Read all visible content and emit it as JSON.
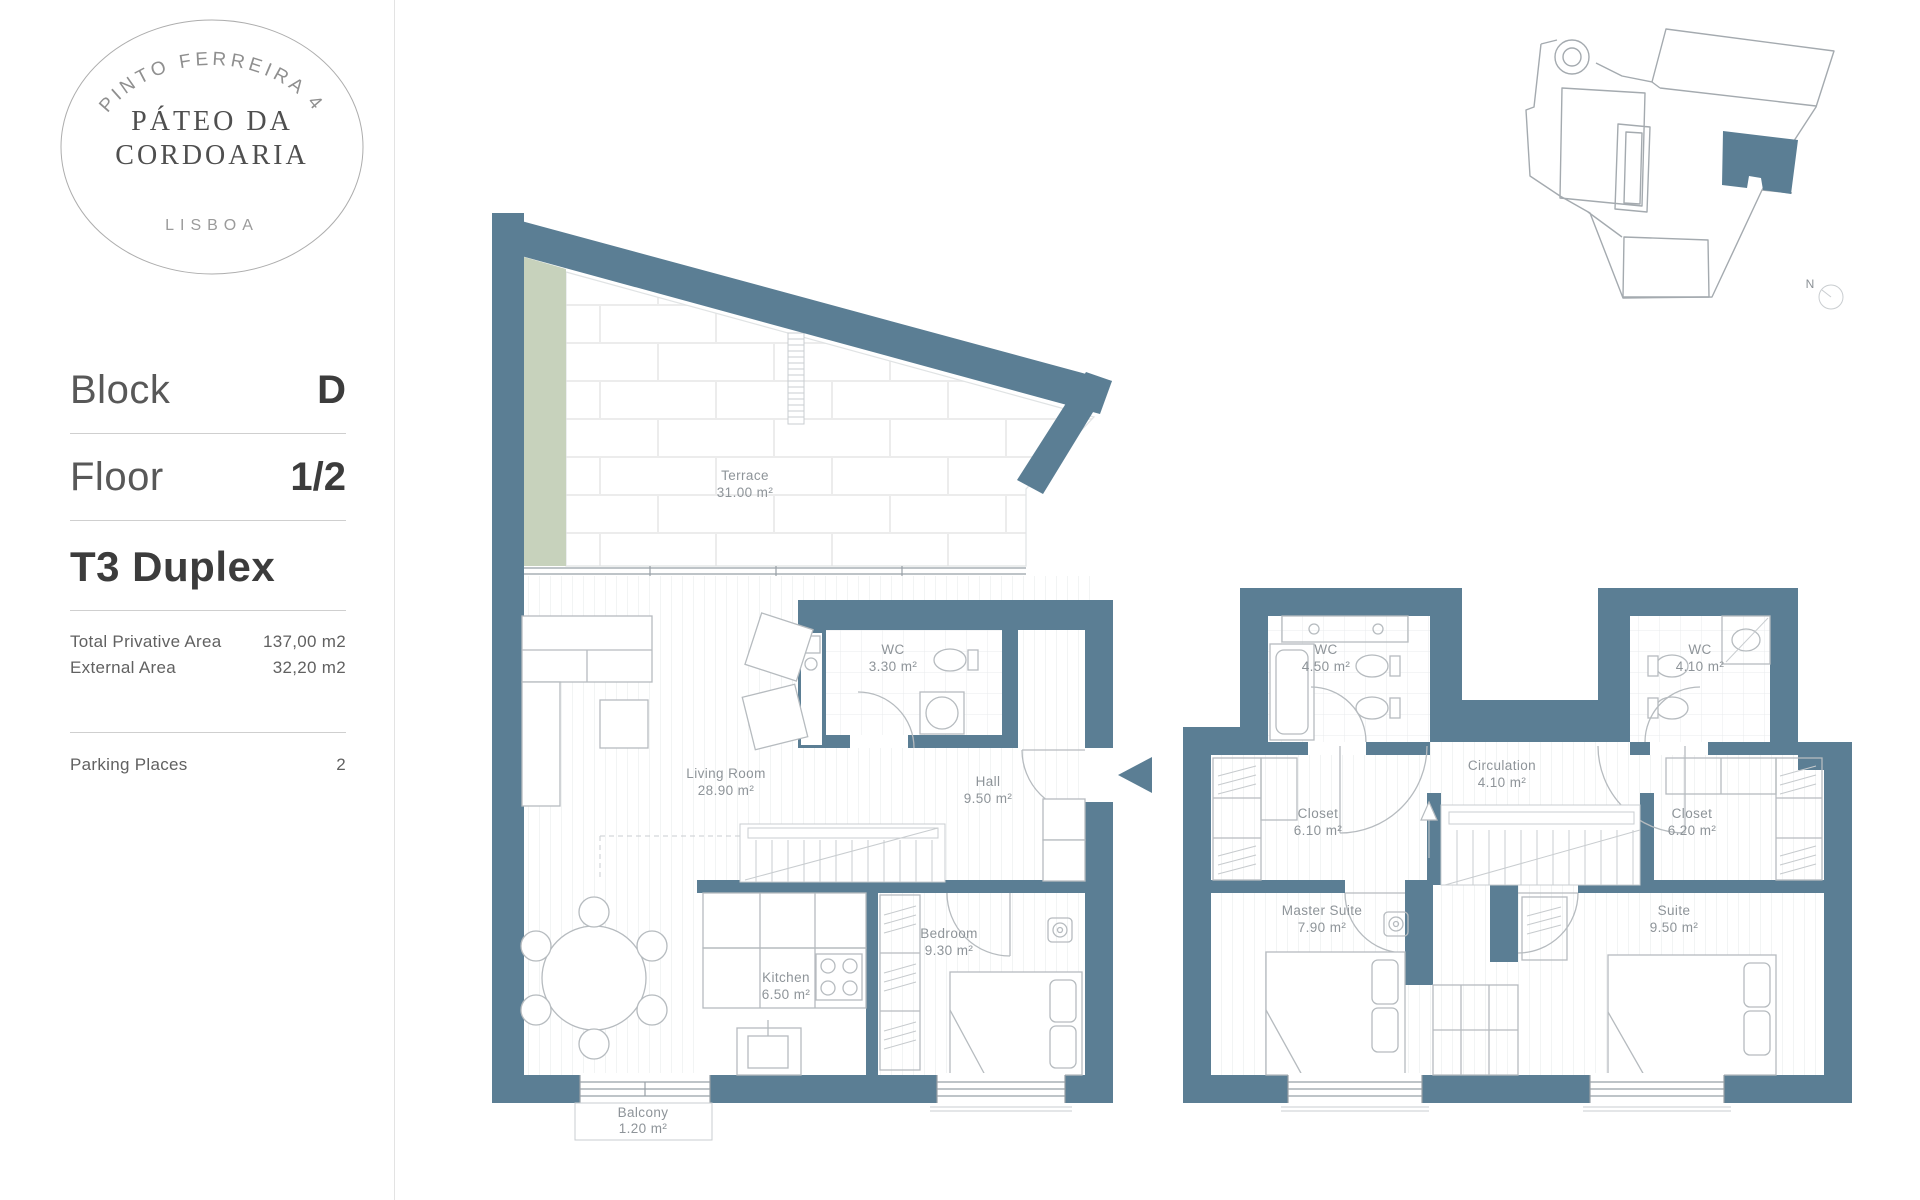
{
  "logo": {
    "project_number": "PINTO FERREIRA 4",
    "title_line1": "PÁTEO DA",
    "title_line2": "CORDOARIA",
    "city": "LISBOA"
  },
  "sidebar": {
    "block": {
      "label": "Block",
      "value": "D"
    },
    "floor": {
      "label": "Floor",
      "value": "1/2"
    },
    "typology": "T3 Duplex",
    "areas": [
      {
        "label": "Total Privative Area",
        "value": "137,00 m2"
      },
      {
        "label": "External Area",
        "value": "32,20 m2"
      }
    ],
    "parking": {
      "label": "Parking Places",
      "value": "2"
    }
  },
  "plan": {
    "wall_color": "#5b7e94",
    "planter_color": "#c7d2bc",
    "north_label": "N",
    "floor1": {
      "terrace": {
        "name": "Terrace",
        "area": "31.00 m²"
      },
      "wc": {
        "name": "WC",
        "area": "3.30 m²"
      },
      "living": {
        "name": "Living Room",
        "area": "28.90 m²"
      },
      "hall": {
        "name": "Hall",
        "area": "9.50 m²"
      },
      "kitchen": {
        "name": "Kitchen",
        "area": "6.50 m²"
      },
      "bedroom": {
        "name": "Bedroom",
        "area": "9.30 m²"
      },
      "balcony": {
        "name": "Balcony",
        "area": "1.20 m²"
      }
    },
    "floor2": {
      "wc_left": {
        "name": "WC",
        "area": "4.50 m²"
      },
      "wc_right": {
        "name": "WC",
        "area": "4.10 m²"
      },
      "closet_left": {
        "name": "Closet",
        "area": "6.10 m²"
      },
      "circulation": {
        "name": "Circulation",
        "area": "4.10 m²"
      },
      "closet_right": {
        "name": "Closet",
        "area": "6.20 m²"
      },
      "master_suite": {
        "name": "Master Suite",
        "area": "7.90 m²"
      },
      "suite": {
        "name": "Suite",
        "area": "9.50 m²"
      }
    }
  }
}
